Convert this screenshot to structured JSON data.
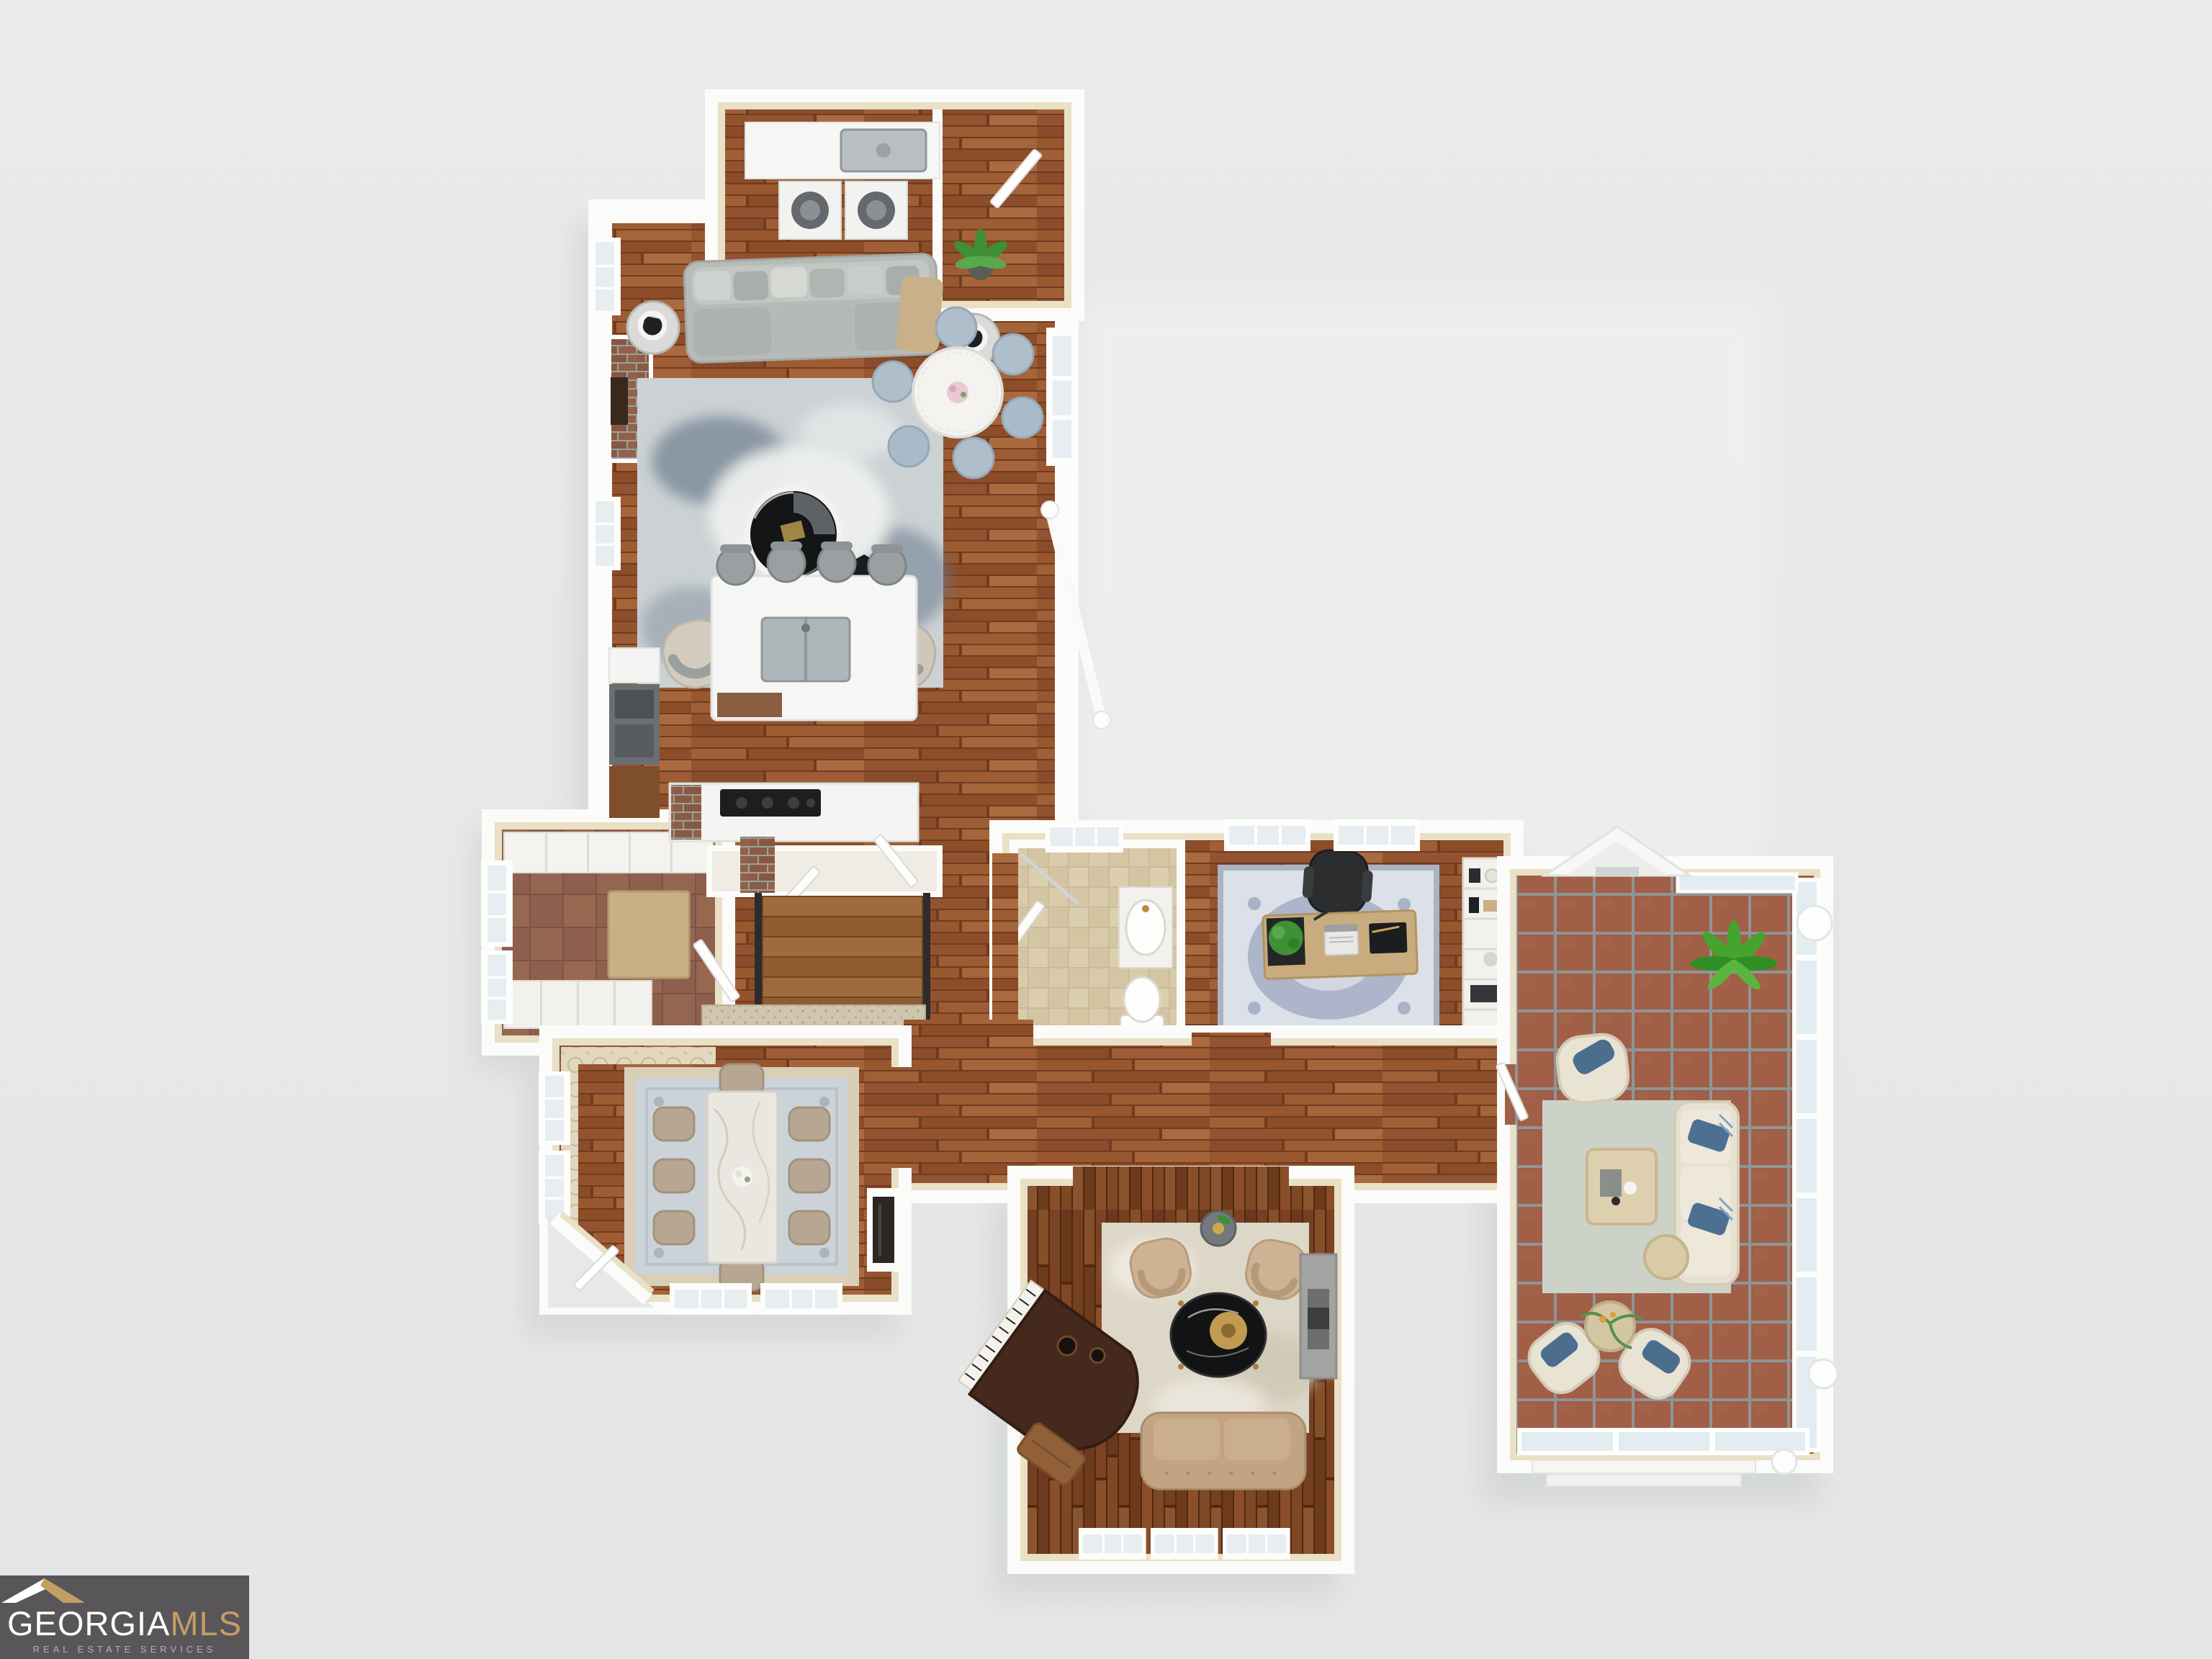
{
  "watermark": {
    "brand_primary": "GEORGIA",
    "brand_secondary": "MLS",
    "tagline": "REAL ESTATE SERVICES",
    "colors": {
      "background": "#59565a",
      "primary_text": "#ffffff",
      "secondary_text": "#c59e62",
      "tagline_text": "#b3b0b3",
      "roof_left": "#ffffff",
      "roof_right": "#c59e62"
    }
  },
  "scene": {
    "type": "3d-floor-plan-render",
    "view": "top-down-dollhouse",
    "background_color": "#e7e9e8",
    "wall_color": "#fbfbf9",
    "wall_face_color": "#e9e0c6",
    "floors": {
      "hardwood": "#99582f",
      "hardwood_dark": "#7b4323",
      "mudroom_tile": "#946651",
      "bath_tile": "#d9cba9",
      "sunroom_tile": "#a05f46"
    },
    "rooms": [
      {
        "id": "laundry-room",
        "floor": "hardwood",
        "items": [
          "counter-with-sink",
          "washer",
          "dryer",
          "door"
        ]
      },
      {
        "id": "living-room",
        "floor": "hardwood",
        "items": [
          "sectional-sofa",
          "throw-blanket",
          "abstract-rug",
          "round-marble-coffee-table",
          "swivel-armchair",
          "swivel-armchair",
          "hex-side-table",
          "lamp-side-table",
          "lamp-side-table",
          "brick-fireplace",
          "round-breakfast-table",
          "six-blue-chairs",
          "flower-centerpiece"
        ]
      },
      {
        "id": "kitchen",
        "floor": "hardwood",
        "items": [
          "island-with-sink",
          "four-bar-stools",
          "cooktop-counter",
          "oven-stack",
          "brick-chimney"
        ]
      },
      {
        "id": "stair-hall",
        "floor": "hardwood",
        "items": [
          "staircase",
          "black-handrails",
          "white-banister",
          "doormat",
          "potted-plant",
          "closet-doors"
        ]
      },
      {
        "id": "mudroom-entry",
        "floor": "mudroom_tile",
        "items": [
          "built-in-cabinets",
          "console-table",
          "cubby-bench",
          "entry-door",
          "windows"
        ]
      },
      {
        "id": "powder-bath",
        "floor": "bath_tile",
        "items": [
          "vanity-sink",
          "toilet",
          "shower",
          "door"
        ]
      },
      {
        "id": "office",
        "floor": "hardwood",
        "items": [
          "wood-desk",
          "laptop",
          "black-office-chair",
          "blue-medallion-rug",
          "bookshelf",
          "desk-plant"
        ]
      },
      {
        "id": "formal-dining",
        "floor": "hardwood",
        "items": [
          "marble-dining-table",
          "eight-upholstered-chairs",
          "bordered-rug",
          "fireplace",
          "wallpaper-accent",
          "flower-centerpiece",
          "windows"
        ]
      },
      {
        "id": "music-room",
        "floor": "hardwood_dark",
        "items": [
          "grand-piano",
          "piano-bench",
          "tufted-sofa",
          "armchair",
          "armchair",
          "round-black-coffee-table",
          "gold-tray",
          "plant-side-table",
          "stone-fireplace",
          "cream-rug",
          "windows"
        ]
      },
      {
        "id": "sunroom",
        "floor": "sunroom_tile",
        "items": [
          "glass-walls",
          "gable-roof",
          "palm-plant",
          "wicker-armchair",
          "wicker-armchair",
          "wicker-armchair",
          "wicker-sofa-blue-cushions",
          "coffee-table",
          "round-side-table",
          "gray-rug",
          "roof-finials",
          "steps"
        ]
      }
    ]
  }
}
